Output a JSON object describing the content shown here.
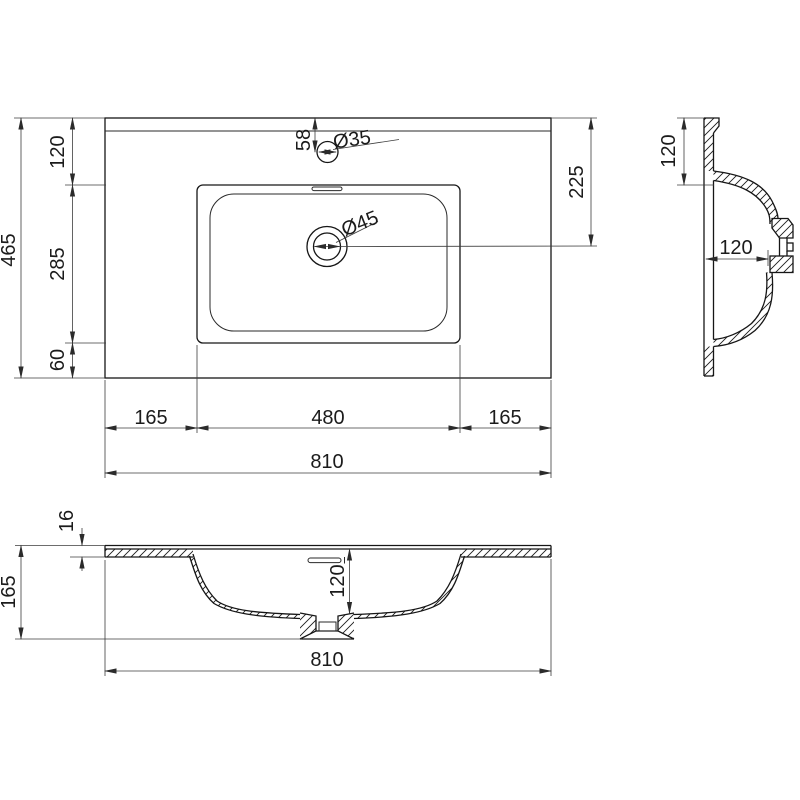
{
  "drawing": {
    "type": "technical-dimension-drawing",
    "subject": "rectangular vanity washbasin",
    "background_color": "#ffffff",
    "object_line_color": "#161616",
    "dimension_line_color": "#3c3c3c",
    "views": {
      "plan": {
        "title": "top view",
        "dims": {
          "overall_width": "810",
          "overall_depth": "465",
          "back_margin_depth": "120",
          "basin_depth": "285",
          "front_margin_depth": "60",
          "left_margin_width": "165",
          "basin_width": "480",
          "right_margin_width": "165",
          "faucet_hole_offset": "58",
          "faucet_hole_diameter": "Ø35",
          "drain_diameter": "Ø45",
          "drain_center_from_back": "225"
        }
      },
      "side_section": {
        "title": "side section view",
        "dims": {
          "back_margin_depth": "120",
          "bowl_inner_depth": "120"
        }
      },
      "front_section": {
        "title": "front section view",
        "dims": {
          "overall_width": "810",
          "overall_height": "165",
          "top_thickness": "16",
          "bowl_inner_depth": "120"
        }
      }
    }
  }
}
